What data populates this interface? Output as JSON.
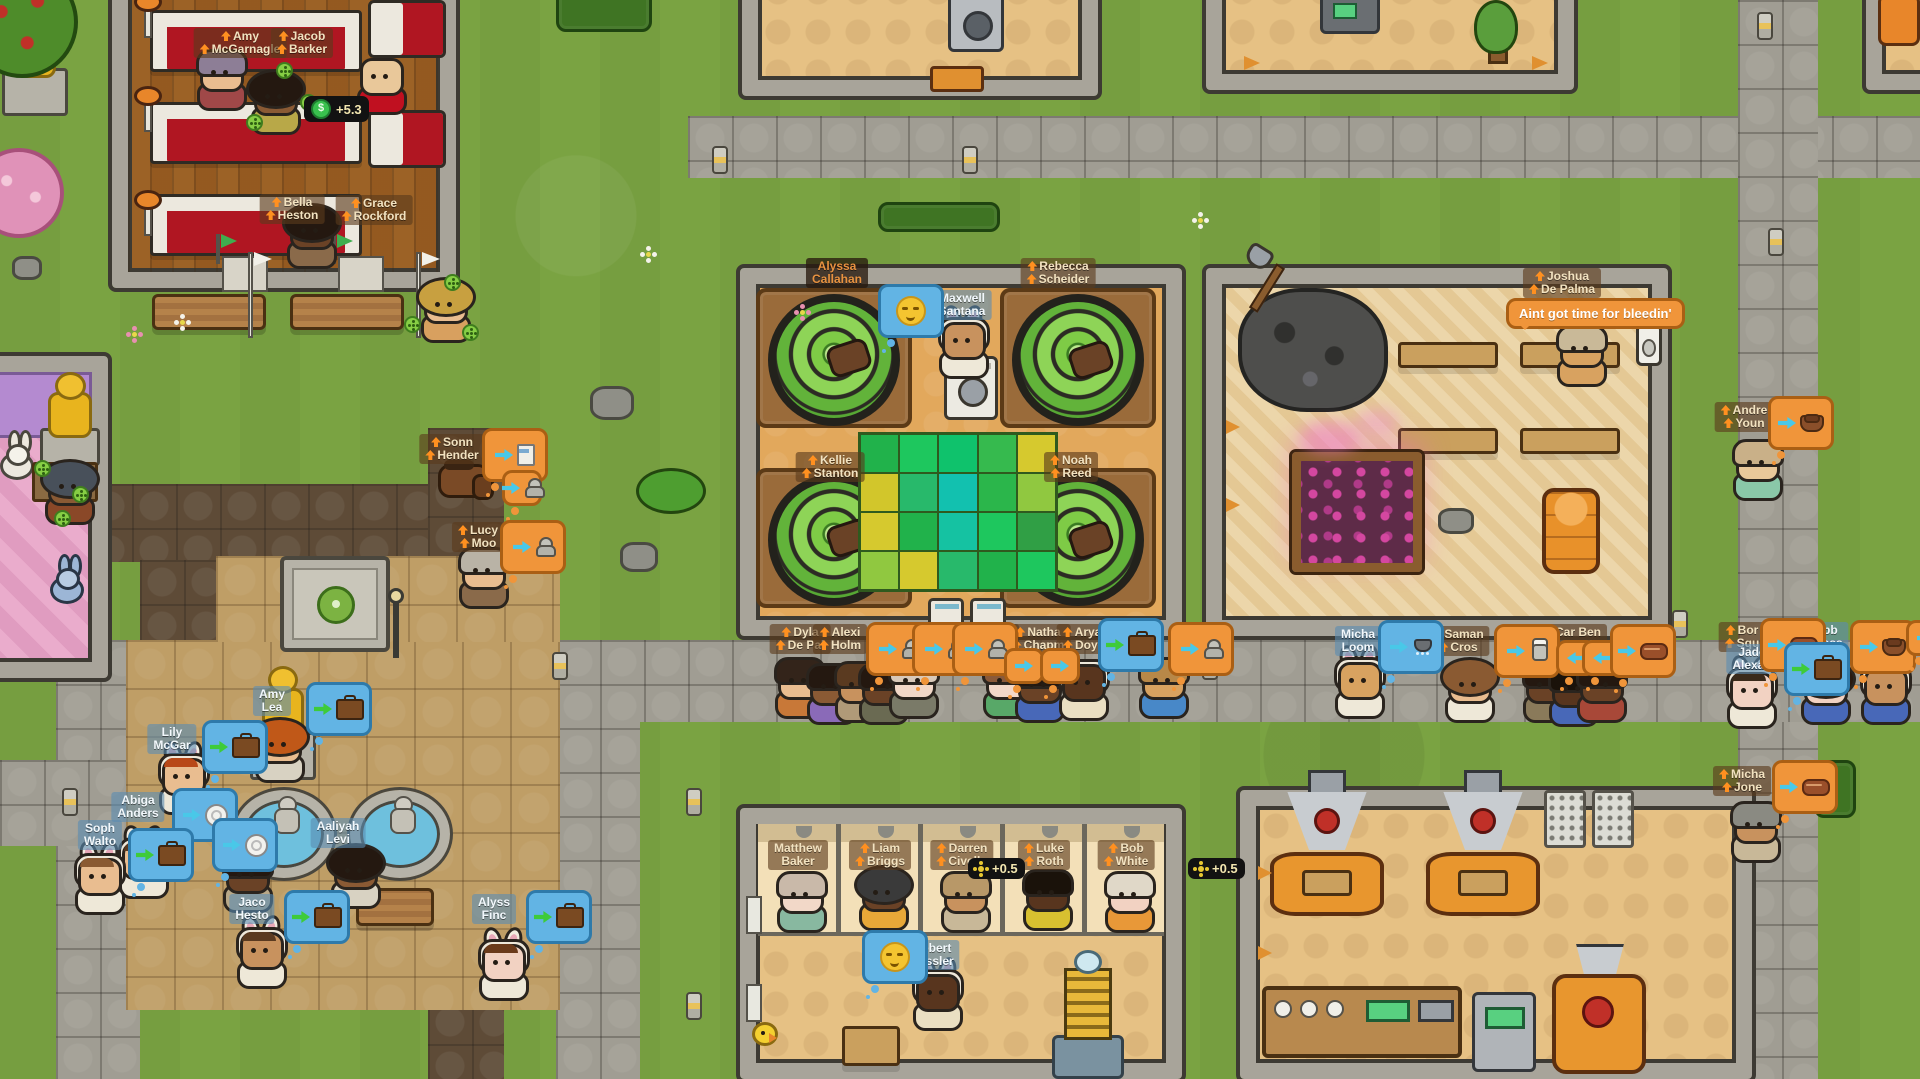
{
  "plaques": {
    "statue": "Emily Baker"
  },
  "speech": {
    "joshua": "Aint got time for bleedin'"
  },
  "badges": [
    {
      "x": 304,
      "y": 96,
      "icon": "money",
      "symbol": "$",
      "label": "+5.3"
    },
    {
      "x": 968,
      "y": 858,
      "icon": "spin",
      "label": "+0.5"
    },
    {
      "x": 1188,
      "y": 858,
      "icon": "spin",
      "label": "+0.5"
    }
  ],
  "colors": {
    "grass": "#7aa342",
    "stone_path": "#a09d93",
    "dirt_path": "#5e4b37",
    "plaza": "#bf9e66",
    "wall": "#a8a49a",
    "banner_tan": "#f2e2c0",
    "banner_blue": "#f2f8fc",
    "bubble_orange": "#f0953a",
    "bubble_blue": "#62b4e4",
    "drum_green": "#7ecb46",
    "pew_red": "#b01622",
    "gold": "#e8b41e"
  },
  "laundry_mat": [
    "#21b24b",
    "#1ec75e",
    "#0fc26c",
    "#36ba4e",
    "#d6c92e",
    "#d2c62b",
    "#28b96b",
    "#12c1af",
    "#2bb64b",
    "#90c840",
    "#d6c92e",
    "#21b24b",
    "#15c2a2",
    "#1ec75e",
    "#309f45",
    "#90c840",
    "#d6c92e",
    "#28b96b",
    "#21b24b",
    "#1ec75e"
  ],
  "characters": [
    {
      "name": [
        "Amy",
        "McGarnagle"
      ],
      "b": "tan",
      "up": true,
      "bx": 240,
      "by": 28,
      "s": {
        "x": 196,
        "y": 54,
        "sk": "#e9bd90",
        "hr": "#8d7e96",
        "sh": "#a04848"
      }
    },
    {
      "name": [
        "Jacob",
        "Barker"
      ],
      "b": "tan",
      "up": true,
      "bx": 302,
      "by": 28
    },
    {
      "name": [
        "Bella",
        "Heston"
      ],
      "b": "tan",
      "up": true,
      "bx": 292,
      "by": 194
    },
    {
      "name": [
        "Grace",
        "Rockford"
      ],
      "b": "tan",
      "up": true,
      "bx": 374,
      "by": 195
    },
    {
      "name": [
        "Alyssa",
        "Callahan"
      ],
      "b": "dark",
      "up": false,
      "bx": 837,
      "by": 258
    },
    {
      "name": [
        "Rebecca",
        "Scheider"
      ],
      "b": "tan",
      "up": true,
      "bx": 1058,
      "by": 258
    },
    {
      "name": [
        "Maxwell",
        "Santana"
      ],
      "b": "blue",
      "up": false,
      "bx": 962,
      "by": 290,
      "s": {
        "x": 938,
        "y": 322,
        "sk": "#c8925e",
        "hr": null,
        "sh": "#eee8d8",
        "ears": true
      },
      "bub": {
        "x": 878,
        "y": 284,
        "st": "b",
        "ic": "face"
      }
    },
    {
      "name": [
        "Kellie",
        "Stanton"
      ],
      "b": "tan",
      "up": true,
      "bx": 830,
      "by": 452
    },
    {
      "name": [
        "Noah",
        "Reed"
      ],
      "b": "tan",
      "up": true,
      "bx": 1071,
      "by": 452
    },
    {
      "name": [
        "Joshua",
        "De Palma"
      ],
      "b": "tan",
      "up": true,
      "bx": 1562,
      "by": 268,
      "s": {
        "x": 1556,
        "y": 330,
        "sk": "#d8a260",
        "hr": "#c9b998",
        "sh": "#d8a260"
      },
      "bub": {
        "x": 1506,
        "y": 298,
        "st": "ob",
        "tx": "joshua"
      }
    },
    {
      "name": [
        "Sonn",
        "Hender"
      ],
      "b": "tan",
      "up": true,
      "bx": 452,
      "by": 434,
      "bub": {
        "x": 482,
        "y": 428,
        "st": "o",
        "ic": "milk",
        "ar": "c"
      }
    },
    {
      "b": null,
      "bub": {
        "x": 502,
        "y": 470,
        "st": "o",
        "ic": "person",
        "ar": "c",
        "small": true
      }
    },
    {
      "name": [
        "Lucy",
        "Moo"
      ],
      "b": "tan",
      "up": true,
      "bx": 478,
      "by": 522,
      "s": {
        "x": 458,
        "y": 552,
        "sk": "#e9bd90",
        "hr": "#b9b3a6",
        "sh": "#8a6a4a"
      },
      "bub": {
        "x": 500,
        "y": 520,
        "st": "o",
        "ic": "person",
        "ar": "c"
      }
    },
    {
      "name": [
        "Dyla",
        "De Pal"
      ],
      "b": "tan",
      "up": true,
      "bx": 800,
      "by": 624,
      "s": {
        "x": 774,
        "y": 662,
        "sk": "#e9bd90",
        "hr": "#33241a",
        "sh": "#c87838"
      }
    },
    {
      "name": [
        "Alexi",
        "Holm"
      ],
      "b": "tan",
      "up": true,
      "bx": 840,
      "by": 624,
      "s": {
        "x": 806,
        "y": 668,
        "sk": "#8a5a34",
        "hr": "#241810",
        "sh": "#8a6ab8"
      }
    },
    {
      "b": null,
      "bub": {
        "x": 866,
        "y": 622,
        "st": "o",
        "ic": "person",
        "ar": "c"
      },
      "s": {
        "x": 834,
        "y": 666,
        "sk": "#c8925e",
        "hr": "#5a3a20",
        "sh": "#b09a78"
      }
    },
    {
      "b": null,
      "bub": {
        "x": 912,
        "y": 622,
        "st": "o",
        "ic": "person",
        "ar": "c"
      },
      "s": {
        "x": 858,
        "y": 668,
        "sk": "#6a4226",
        "hr": "#241810",
        "sh": "#6a6a52"
      }
    },
    {
      "b": null,
      "bub": {
        "x": 952,
        "y": 622,
        "st": "o",
        "ic": "person",
        "ar": "c"
      },
      "s": {
        "x": 888,
        "y": 662,
        "sk": "#f2d8c8",
        "hr": "#d9c9b9",
        "sh": "#7a7a68"
      }
    },
    {
      "name": [
        "Mic",
        "Mor"
      ],
      "b": "tan",
      "up": true,
      "bx": 996,
      "by": 624,
      "s": {
        "x": 982,
        "y": 662,
        "sk": "#f2d8c8",
        "hr": "#8a5a3a",
        "sh": "#58a868"
      }
    },
    {
      "name": [
        "Natha",
        "Chapm"
      ],
      "b": "tan",
      "up": true,
      "bx": 1038,
      "by": 624,
      "s": {
        "x": 1014,
        "y": 666,
        "sk": "#6a4226",
        "hr": "#241810",
        "sh": "#4868b8"
      },
      "bub": {
        "x": 1004,
        "y": 648,
        "st": "o",
        "ar": "c",
        "small": true
      }
    },
    {
      "name": [
        "Arya",
        "Doyl"
      ],
      "b": "tan",
      "up": true,
      "bx": 1082,
      "by": 624,
      "s": {
        "x": 1058,
        "y": 664,
        "sk": "#58351e",
        "hr": null,
        "hood": true,
        "sh": "#eadfc2"
      },
      "bub": {
        "x": 1040,
        "y": 648,
        "st": "o",
        "ar": "c",
        "small": true
      }
    },
    {
      "b": null,
      "bub": {
        "x": 1098,
        "y": 618,
        "st": "b",
        "ic": "case",
        "ar": "g"
      }
    },
    {
      "b": null,
      "bub": {
        "x": 1168,
        "y": 622,
        "st": "o",
        "ic": "person",
        "ar": "c"
      },
      "s": {
        "x": 1138,
        "y": 662,
        "sk": "#d8a260",
        "hr": "#b88848",
        "sh": "#4888c8"
      }
    },
    {
      "name": [
        "Micha",
        "Loom"
      ],
      "b": "blue",
      "up": false,
      "bx": 1358,
      "by": 626,
      "s": {
        "x": 1334,
        "y": 662,
        "sk": "#d8a260",
        "hr": null,
        "ears": true,
        "hood": true,
        "sh": "#eee8d8"
      },
      "bub": {
        "x": 1378,
        "y": 620,
        "st": "b",
        "ic": "shower",
        "ar": "c"
      }
    },
    {
      "name": [
        "Saman",
        "Cros"
      ],
      "b": "tan",
      "up": true,
      "bx": 1458,
      "by": 626,
      "s": {
        "x": 1444,
        "y": 666,
        "sk": "#e9bd90",
        "hr": "#8a5a32",
        "bighair": true,
        "sh": "#eee8d8"
      }
    },
    {
      "name": [
        "Jos  Car  Ben",
        "Col Saval"
      ],
      "b": "tan",
      "up": true,
      "bx": 1560,
      "by": 624,
      "s": {
        "x": 1522,
        "y": 666,
        "sk": "#6a4226",
        "hr": "#241810",
        "sh": "#8a7a5a"
      }
    },
    {
      "b": null,
      "bub": {
        "x": 1494,
        "y": 624,
        "st": "o",
        "ic": "chef",
        "ar": "c"
      },
      "s": {
        "x": 1548,
        "y": 670,
        "sk": "#58351e",
        "hr": "#1a120a",
        "sh": "#4868b8"
      }
    },
    {
      "b": null,
      "bub": {
        "x": 1556,
        "y": 640,
        "st": "o",
        "ar": "cl",
        "small": true
      },
      "s": {
        "x": 1576,
        "y": 666,
        "sk": "#6a4226",
        "hr": "#241810",
        "sh": "#a84838"
      }
    },
    {
      "b": null,
      "bub": {
        "x": 1582,
        "y": 640,
        "st": "o",
        "ar": "cl",
        "small": true
      }
    },
    {
      "b": null,
      "bub": {
        "x": 1610,
        "y": 624,
        "st": "o",
        "ic": "meat",
        "ar": "c"
      }
    },
    {
      "name": [
        "Andre",
        "Youn"
      ],
      "b": "tan",
      "up": true,
      "bx": 1744,
      "by": 402,
      "s": {
        "x": 1732,
        "y": 444,
        "sk": "#e9c89a",
        "hr": "#c9b088",
        "sh": "#8ac8a8"
      },
      "bub": {
        "x": 1768,
        "y": 396,
        "st": "o",
        "ic": "bowl",
        "ar": "c"
      }
    },
    {
      "name": [
        "Bor",
        "Squ"
      ],
      "b": "tan",
      "up": true,
      "bx": 1742,
      "by": 622,
      "bub": {
        "x": 1760,
        "y": 618,
        "st": "o",
        "ic": "meat",
        "ar": "c"
      }
    },
    {
      "name": [
        "Jade",
        "Alexan"
      ],
      "b": "blue",
      "up": false,
      "bx": 1752,
      "by": 644,
      "s": {
        "x": 1726,
        "y": 672,
        "sk": "#f2d2c2",
        "hr": "#3a2a1a",
        "ears": true,
        "hood": true,
        "sh": "#eee8d8"
      },
      "bub": {
        "x": 1784,
        "y": 642,
        "st": "b",
        "ic": "case",
        "ar": "g"
      }
    },
    {
      "name": [
        "Abb",
        "Bress"
      ],
      "b": "blue",
      "up": false,
      "bx": 1826,
      "by": 622,
      "s": {
        "x": 1800,
        "y": 668,
        "sk": "#f2d2c2",
        "hr": "#2a1a10",
        "bighair": true,
        "sh": "#4868b8"
      },
      "bub": {
        "x": 1850,
        "y": 620,
        "st": "o",
        "ic": "bowl",
        "ar": "c"
      }
    },
    {
      "name": [
        "Emil",
        "Bibb"
      ],
      "b": "blue",
      "up": false,
      "bx": 1884,
      "by": 622,
      "s": {
        "x": 1860,
        "y": 668,
        "sk": "#c8925e",
        "hr": null,
        "hood": true,
        "sh": "#4868b8"
      },
      "bub": {
        "x": 1906,
        "y": 620,
        "st": "o",
        "ar": "c",
        "small": true
      }
    },
    {
      "name": [
        "Micha",
        "Jone"
      ],
      "b": "tan",
      "up": true,
      "bx": 1742,
      "by": 766,
      "s": {
        "x": 1730,
        "y": 806,
        "sk": "#c8925e",
        "hr": "#8a8a82",
        "sh": "#c8b898"
      },
      "bub": {
        "x": 1772,
        "y": 760,
        "st": "o",
        "ic": "meat",
        "ar": "c"
      }
    },
    {
      "name": [
        "Matthew",
        "Baker"
      ],
      "b": "tan",
      "up": false,
      "bx": 798,
      "by": 840,
      "s": {
        "x": 776,
        "y": 876,
        "sk": "#f2d8c8",
        "hr": "#c9b9a9",
        "sh": "#88b8a0"
      }
    },
    {
      "name": [
        "Liam",
        "Briggs"
      ],
      "b": "tan",
      "up": true,
      "bx": 880,
      "by": 840,
      "s": {
        "x": 858,
        "y": 874,
        "sk": "#6a4226",
        "hr": "#3a3a3a",
        "bighair": true,
        "sh": "#e8a838"
      }
    },
    {
      "name": [
        "Darren",
        "Civello"
      ],
      "b": "tan",
      "up": true,
      "bx": 962,
      "by": 840,
      "s": {
        "x": 940,
        "y": 876,
        "sk": "#c8925e",
        "hr": "#b89868",
        "sh": "#c8b898"
      }
    },
    {
      "name": [
        "Luke",
        "Roth"
      ],
      "b": "tan",
      "up": true,
      "bx": 1044,
      "by": 840,
      "s": {
        "x": 1022,
        "y": 874,
        "sk": "#58351e",
        "hr": "#1a120a",
        "sh": "#d8c030"
      }
    },
    {
      "name": [
        "Bob",
        "White"
      ],
      "b": "tan",
      "up": true,
      "bx": 1126,
      "by": 840,
      "s": {
        "x": 1104,
        "y": 876,
        "sk": "#f2d2c2",
        "hr": "#e0d8c8",
        "sh": "#e89838"
      }
    },
    {
      "name": [
        "Robert",
        "Kessler"
      ],
      "b": "blue",
      "up": false,
      "bx": 932,
      "by": 940,
      "s": {
        "x": 912,
        "y": 974,
        "sk": "#58351e",
        "hr": null,
        "ears": true,
        "hood": true,
        "sh": "#eadfc2"
      },
      "bub": {
        "x": 862,
        "y": 930,
        "st": "b",
        "ic": "face"
      }
    },
    {
      "name": [
        "Lily",
        "McGar"
      ],
      "b": "blue",
      "up": false,
      "bx": 172,
      "by": 724,
      "s": {
        "x": 158,
        "y": 758,
        "sk": "#e9bd90",
        "hr": "#b84818",
        "ears": true,
        "hood": true,
        "sh": "#eee8d8"
      },
      "bub": {
        "x": 202,
        "y": 720,
        "st": "b",
        "ic": "case",
        "ar": "g"
      }
    },
    {
      "name": [
        "Amy",
        "Lea"
      ],
      "b": "blue",
      "up": false,
      "bx": 272,
      "by": 686,
      "s": {
        "x": 254,
        "y": 726,
        "sk": "#e9bd90",
        "hr": "#c05818",
        "bighair": true,
        "sh": "#d8d2c2"
      },
      "bub": {
        "x": 306,
        "y": 682,
        "st": "b",
        "ic": "case",
        "ar": "g"
      }
    },
    {
      "name": [
        "Abiga",
        "Anders"
      ],
      "b": "blue",
      "up": false,
      "bx": 138,
      "by": 792,
      "s": {
        "x": 118,
        "y": 842,
        "sk": "#e9bd90",
        "hr": "#5a3a20",
        "ears": true,
        "hood": true,
        "sh": "#eee8d8"
      },
      "bub": {
        "x": 172,
        "y": 788,
        "st": "b",
        "ic": "plate",
        "ar": "c"
      }
    },
    {
      "name": [
        "Soph",
        "Walto"
      ],
      "b": "blue",
      "up": false,
      "bx": 100,
      "by": 820,
      "s": {
        "x": 74,
        "y": 858,
        "sk": "#e9bd90",
        "hr": "#8a5a32",
        "ears": true,
        "hood": true,
        "sh": "#eee8d8"
      },
      "bub": {
        "x": 128,
        "y": 828,
        "st": "b",
        "ic": "case",
        "ar": "g"
      }
    },
    {
      "b": null,
      "bub": {
        "x": 212,
        "y": 818,
        "st": "b",
        "ic": "plate",
        "ar": "c"
      },
      "s": {
        "x": 222,
        "y": 856,
        "sk": "#6a4226",
        "hr": "#241810",
        "sh": "#b8a888"
      }
    },
    {
      "name": [
        "Aaliyah",
        "Levi"
      ],
      "b": "blue",
      "up": false,
      "bx": 338,
      "by": 818,
      "s": {
        "x": 330,
        "y": 852,
        "sk": "#8a5a34",
        "hr": "#241810",
        "bighair": true,
        "sh": "#d8d2c2"
      }
    },
    {
      "name": [
        "Jaco",
        "Hesto"
      ],
      "b": "blue",
      "up": false,
      "bx": 252,
      "by": 894,
      "s": {
        "x": 236,
        "y": 932,
        "sk": "#c8925e",
        "hr": "#5a3a20",
        "ears": true,
        "hood": true,
        "sh": "#eee8d8"
      },
      "bub": {
        "x": 284,
        "y": 890,
        "st": "b",
        "ic": "case",
        "ar": "g"
      }
    },
    {
      "name": [
        "Alyss",
        "Finc"
      ],
      "b": "blue",
      "up": false,
      "bx": 494,
      "by": 894,
      "s": {
        "x": 478,
        "y": 944,
        "sk": "#f2d2c2",
        "hr": "#6a3a1a",
        "ears": true,
        "hood": true,
        "sh": "#eee8d8"
      },
      "bub": {
        "x": 526,
        "y": 890,
        "st": "b",
        "ic": "case",
        "ar": "g"
      }
    },
    {
      "b": null,
      "s": {
        "x": 356,
        "y": 58,
        "sk": "#e9c89a",
        "hr": null,
        "sh": "#c01020"
      }
    },
    {
      "b": null,
      "s": {
        "x": 250,
        "y": 78,
        "sk": "#8a5a34",
        "hr": "#241810",
        "bighair": true,
        "sh": "#b8a848"
      }
    },
    {
      "b": null,
      "s": {
        "x": 286,
        "y": 212,
        "sk": "#6a4226",
        "hr": "#241810",
        "bighair": true,
        "sh": "#8a6a4a"
      }
    },
    {
      "b": null,
      "s": {
        "x": 420,
        "y": 286,
        "sk": "#e9bd90",
        "hr": "#c8a040",
        "bighair": true,
        "sh": "#d8a05f"
      }
    },
    {
      "b": null,
      "s": {
        "x": 44,
        "y": 468,
        "sk": "#8a5a34",
        "hr": "#48505a",
        "bighair": true,
        "sh": "#8a4828"
      }
    }
  ]
}
